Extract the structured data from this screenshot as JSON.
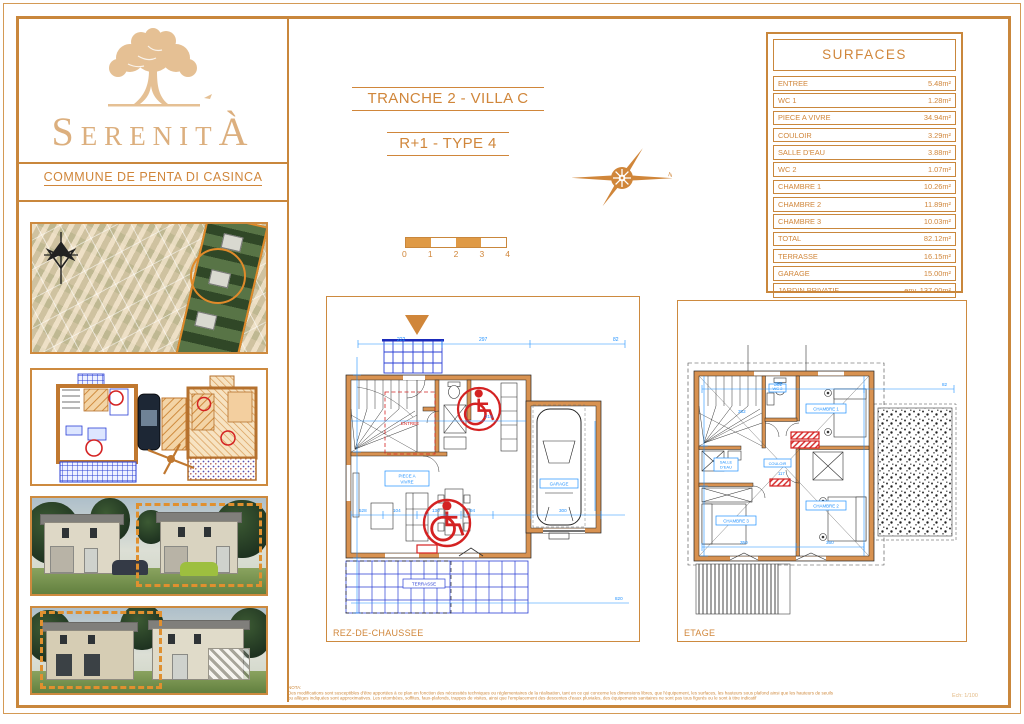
{
  "branding": {
    "logo_text": "SERENITÀ",
    "logo_first": "S",
    "logo_mid": "ERENIT",
    "logo_last": "À",
    "commune": "COMMUNE DE PENTA DI CASINCA"
  },
  "header": {
    "title": "TRANCHE 2 - VILLA C",
    "subtitle": "R+1 -  TYPE 4"
  },
  "scalebar": {
    "ticks": [
      "0",
      "1",
      "2",
      "3",
      "4"
    ]
  },
  "surfaces": {
    "title": "SURFACES",
    "rows": [
      {
        "label": "ENTREE",
        "value": "5.48m²"
      },
      {
        "label": "WC 1",
        "value": "1.28m²"
      },
      {
        "label": "PIECE A VIVRE",
        "value": "34.94m²"
      },
      {
        "label": "COULOIR",
        "value": "3.29m²"
      },
      {
        "label": "SALLE D'EAU",
        "value": "3.88m²"
      },
      {
        "label": "WC 2",
        "value": "1.07m²"
      },
      {
        "label": "CHAMBRE 1",
        "value": "10.26m²"
      },
      {
        "label": "CHAMBRE 2",
        "value": "11.89m²"
      },
      {
        "label": "CHAMBRE 3",
        "value": "10.03m²"
      },
      {
        "label": "TOTAL",
        "value": "82.12m²"
      },
      {
        "label": "TERRASSE",
        "value": "16.15m²"
      },
      {
        "label": "GARAGE",
        "value": "15.00m²"
      },
      {
        "label": "JARDIN PRIVATIF",
        "value": "env. 137.00m²"
      }
    ]
  },
  "plans": {
    "rdc": {
      "caption": "REZ-DE-CHAUSSEE",
      "labels": {
        "living1": "PIECE A",
        "living2": "VIVRE",
        "garage": "GARAGE",
        "terrace": "TERRASSE",
        "entry": "ENTREE"
      },
      "dims": {
        "d1": "222",
        "d2": "297",
        "d3": "82",
        "d4": "528",
        "d5": "104",
        "d6": "130",
        "d7": "94",
        "d8": "300",
        "d9": "215",
        "d10": "820"
      }
    },
    "etage": {
      "caption": "ETAGE",
      "labels": {
        "bedroom1": "CHAMBRE 1",
        "bedroom2": "CHAMBRE 2",
        "bedroom3": "CHAMBRE 3",
        "bath1": "SALLE",
        "bath2": "D'EAU",
        "wc": "WC 2",
        "hall": "COULOIR"
      },
      "dims": {
        "d1": "352",
        "d2": "302",
        "d3": "117",
        "d4": "350",
        "d5": "360",
        "d6": "82"
      }
    }
  },
  "nota": {
    "heading": "NOTA:",
    "line1": "Des modifications sont susceptibles d'être apportées à ce plan en fonction des nécessités techniques ou réglementaires de la réalisation, tant en ce qui concerne les dimensions libres, que l'équipement, les surfaces, les hauteurs sous plafond ainsi que les hauteurs de seuils",
    "line2": "ou allèges indiquées sont approximatives. Les retombées, soffites, faux-plafonds, trappes de visites, ainsi que l'emplacement des descentes d'eaux pluviales, des équipements sanitaires ne sont pas tous figurés ou le sont à titre indicatif",
    "scale_ref": "Ech: 1/100"
  },
  "colors": {
    "accent": "#cd8a3f",
    "wall": "#d89251",
    "dim_blue": "#1e90ff",
    "grid_blue": "#2b3fd4",
    "alert_red": "#d42222",
    "logo_tan": "#dcaf7e"
  }
}
